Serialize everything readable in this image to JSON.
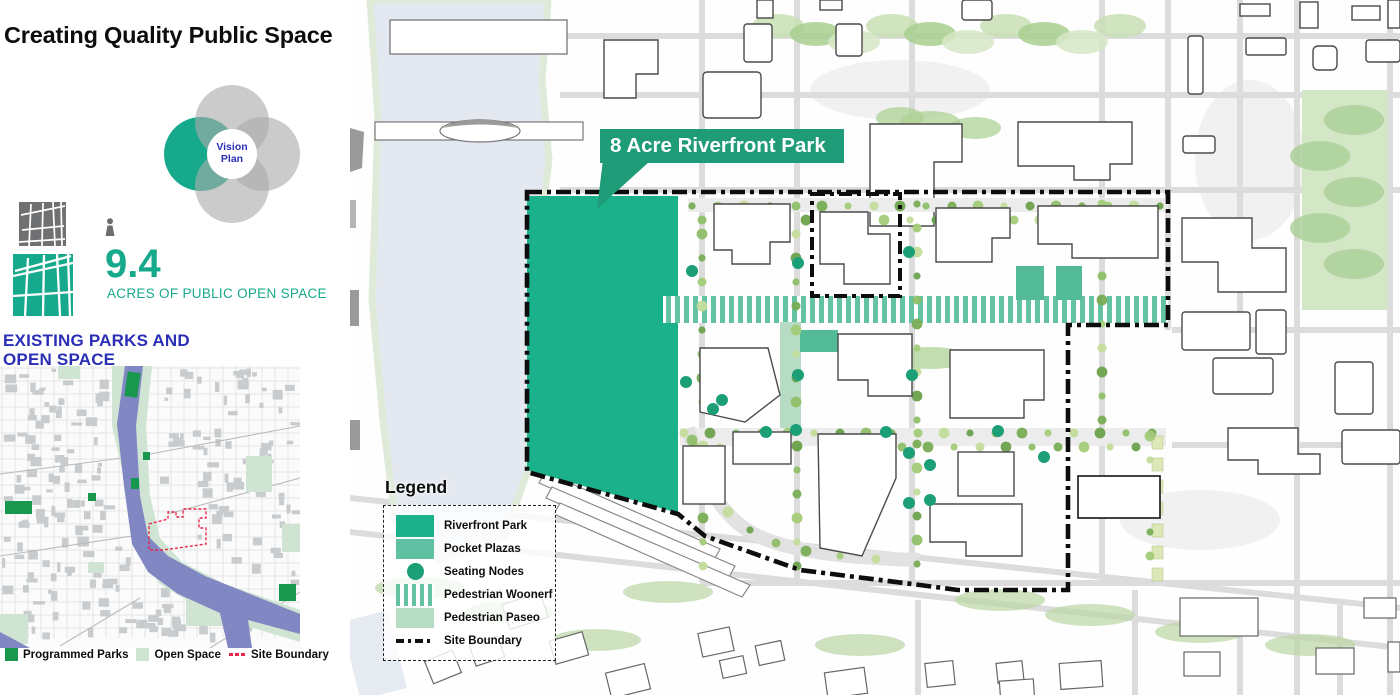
{
  "page": {
    "title": "Creating Quality Public Space"
  },
  "venn": {
    "center_label": "Vision Plan"
  },
  "stats": {
    "value": "9.4",
    "label": "ACRES OF PUBLIC OPEN SPACE"
  },
  "existing_parks": {
    "heading": "EXISTING PARKS AND OPEN SPACE",
    "legend": [
      {
        "label": "Programmed Parks",
        "color": "#18984f"
      },
      {
        "label": "Open Space",
        "color": "#cfe4d2"
      },
      {
        "label": "Site Boundary",
        "color": "#e8274b"
      }
    ]
  },
  "main_map": {
    "callout_label": "8 Acre Riverfront Park",
    "legend_title": "Legend",
    "legend": [
      {
        "label": "Riverfront Park",
        "color": "#1bb28b"
      },
      {
        "label": "Pocket Plazas",
        "color": "#5fc1a1"
      },
      {
        "label": "Seating Nodes",
        "color": "#1c9e76"
      },
      {
        "label": "Pedestrian Woonerf",
        "color": "#63c3a3"
      },
      {
        "label": "Pedestrian Paseo",
        "color": "#b7dcc4"
      },
      {
        "label": "Site Boundary",
        "color": "#111111"
      }
    ]
  },
  "colors": {
    "teal_accent": "#16a98b",
    "callout_green": "#1f9c77",
    "heading_blue": "#2a2fb5",
    "boundary_red": "#e8274b",
    "river_inset": "#8087c3",
    "open_space_green": "#cfe4d2"
  }
}
